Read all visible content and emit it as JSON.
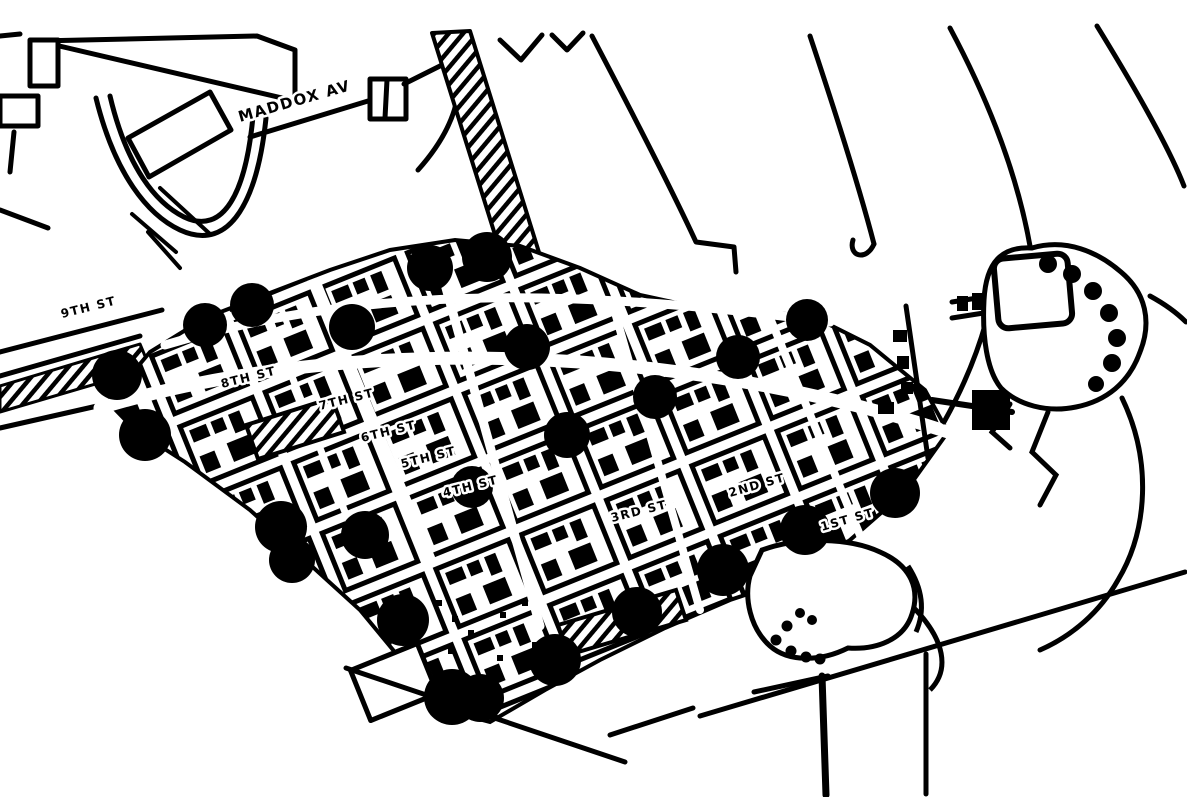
{
  "map": {
    "description": "1-bit scanned black-and-white town street map with large solid dot markers over the downtown grid",
    "colors": {
      "ink": "#000000",
      "paper": "#ffffff"
    },
    "street_labels": [
      {
        "text": "MADDOX AV"
      },
      {
        "text": "9TH ST"
      },
      {
        "text": "8TH ST"
      },
      {
        "text": "7TH ST"
      },
      {
        "text": "6TH ST"
      },
      {
        "text": "5TH ST"
      },
      {
        "text": "4TH ST"
      },
      {
        "text": "3RD ST"
      },
      {
        "text": "2ND ST"
      },
      {
        "text": "1ST ST"
      }
    ],
    "markers": {
      "style": "filled-circle",
      "count": 24,
      "points": [
        {
          "x": 117,
          "y": 375,
          "r": 25
        },
        {
          "x": 145,
          "y": 435,
          "r": 26
        },
        {
          "x": 205,
          "y": 325,
          "r": 22
        },
        {
          "x": 252,
          "y": 305,
          "r": 22
        },
        {
          "x": 352,
          "y": 327,
          "r": 23
        },
        {
          "x": 430,
          "y": 268,
          "r": 23
        },
        {
          "x": 487,
          "y": 257,
          "r": 25
        },
        {
          "x": 527,
          "y": 347,
          "r": 23
        },
        {
          "x": 567,
          "y": 435,
          "r": 23
        },
        {
          "x": 655,
          "y": 397,
          "r": 22
        },
        {
          "x": 738,
          "y": 357,
          "r": 22
        },
        {
          "x": 807,
          "y": 320,
          "r": 21
        },
        {
          "x": 281,
          "y": 527,
          "r": 26
        },
        {
          "x": 292,
          "y": 560,
          "r": 23
        },
        {
          "x": 365,
          "y": 535,
          "r": 24
        },
        {
          "x": 403,
          "y": 620,
          "r": 26
        },
        {
          "x": 452,
          "y": 697,
          "r": 28
        },
        {
          "x": 480,
          "y": 698,
          "r": 24
        },
        {
          "x": 555,
          "y": 660,
          "r": 26
        },
        {
          "x": 637,
          "y": 612,
          "r": 25
        },
        {
          "x": 723,
          "y": 570,
          "r": 26
        },
        {
          "x": 805,
          "y": 530,
          "r": 25
        },
        {
          "x": 895,
          "y": 493,
          "r": 25
        },
        {
          "x": 472,
          "y": 487,
          "r": 21
        }
      ]
    },
    "features": [
      "downtown-street-grid",
      "curved-roads-northwest",
      "lake-peninsula-northeast",
      "pond-southeast",
      "hatched-blocks",
      "railroad-ladder-strips"
    ]
  }
}
